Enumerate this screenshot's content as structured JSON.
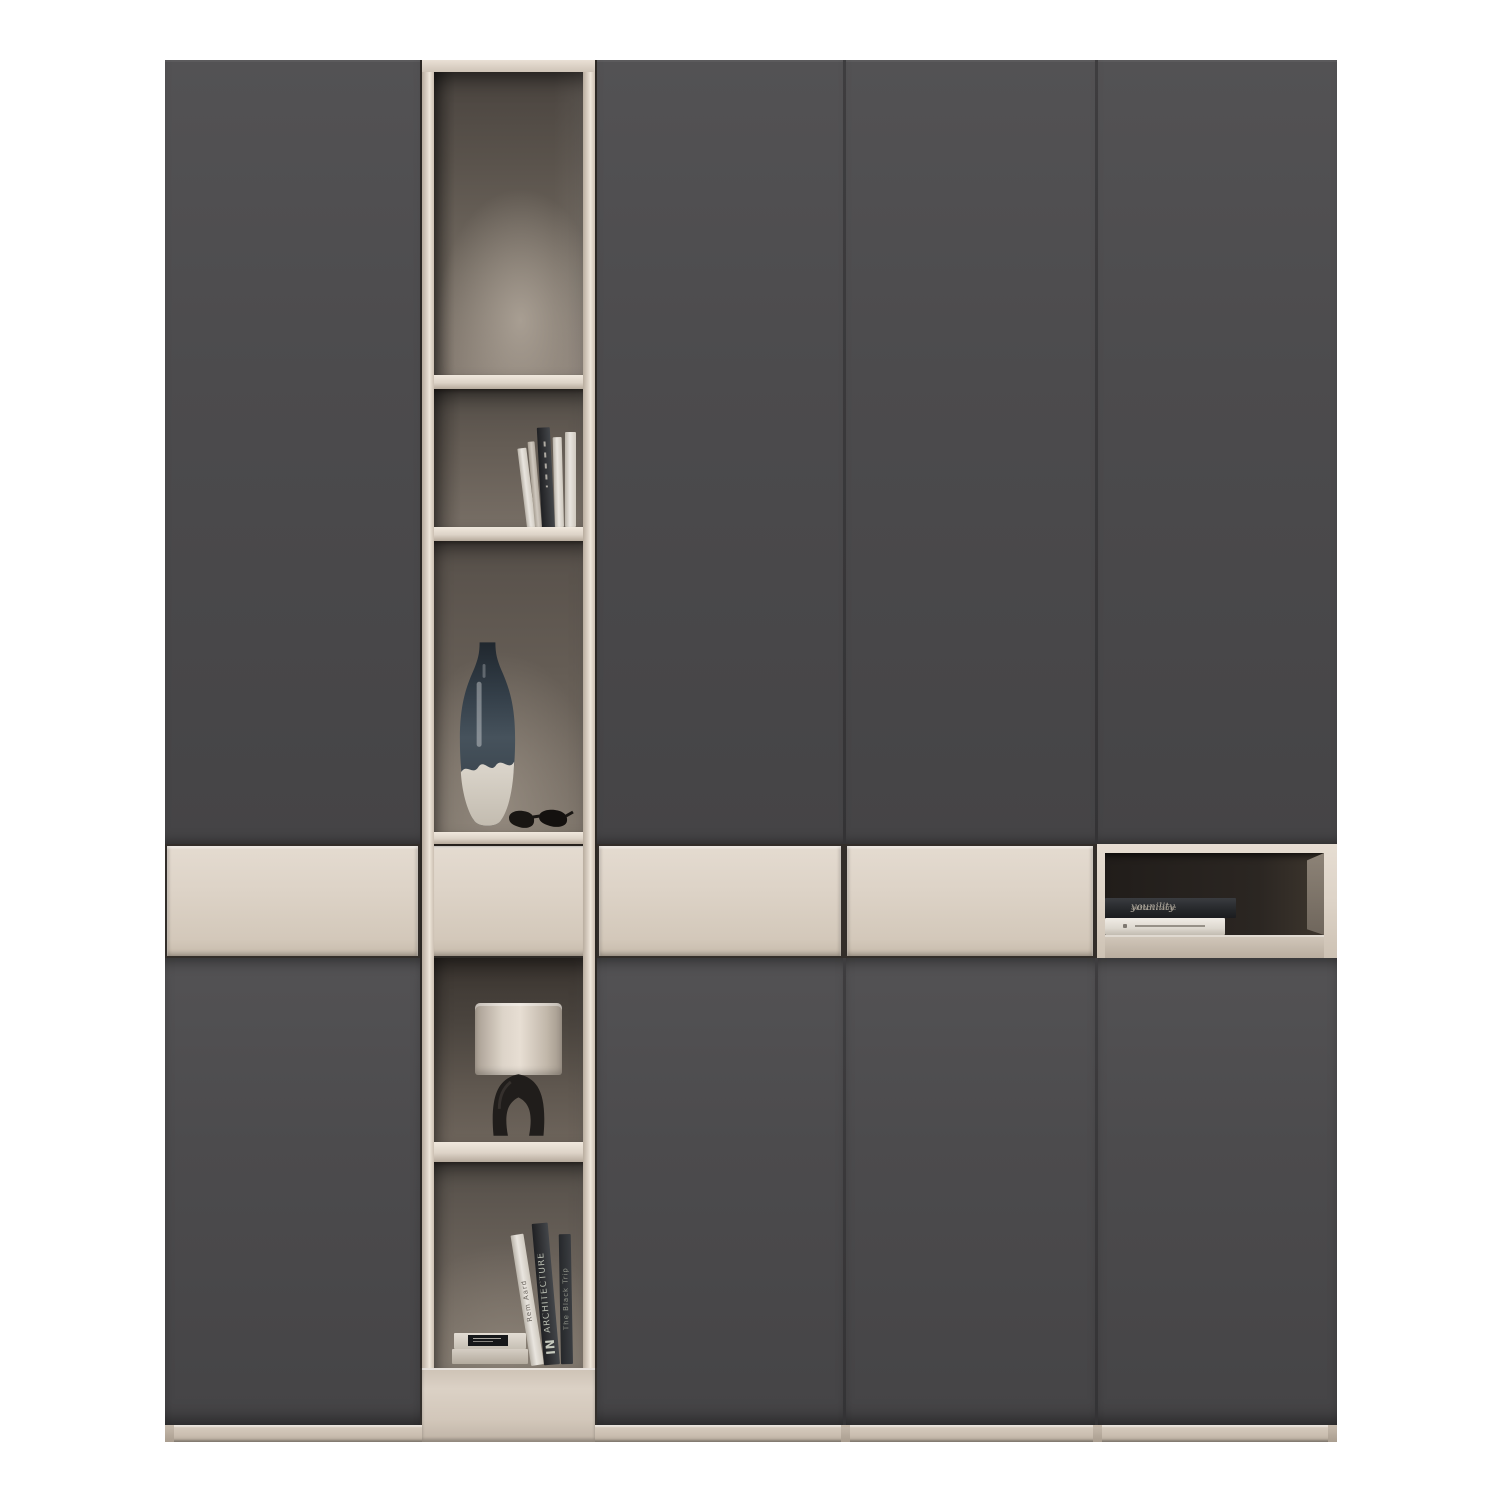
{
  "scene": {
    "type": "furniture-product-photo",
    "description": "Tall modular wardrobe: four dark grey handleless door columns, one beige open shelving column with decor, a beige drawer band across the middle, and an open niche with books at the right end",
    "background": "#ffffff"
  },
  "palette": {
    "bg": "#ffffff",
    "door": "#4c4b4d",
    "door-hi": "#535254",
    "door-lo": "#454446",
    "cream": "#ddd3c7",
    "cream-bright": "#eae1d6",
    "cream-shadow": "#b5a99b",
    "interior-dark": "#4a443f",
    "interior-light": "#a79d92",
    "niche-dark": "#241f1c",
    "dark-book": "#303134",
    "white-book": "#e9e5df",
    "vase-dark": "#2b343d",
    "vase-cream": "#d6d0c6",
    "lamp-shade": "#ddd4c9",
    "lamp-base": "#201d1b"
  },
  "structure": {
    "columns": [
      {
        "label": "left door column"
      },
      {
        "label": "open shelf column"
      },
      {
        "label": "center door column"
      },
      {
        "label": "center-right door column"
      },
      {
        "label": "right door column with open niche"
      }
    ],
    "shelf_column_cubbies": [
      {
        "label": "tall empty cubby"
      },
      {
        "label": "cubby with standing books"
      },
      {
        "label": "cubby with vase and sunglasses"
      },
      {
        "label": "cubby with table lamp"
      },
      {
        "label": "cubby with books"
      }
    ]
  },
  "decor": {
    "upper_books": {
      "label": "standing books",
      "count": 5
    },
    "vase": {
      "label": "two-tone ceramic vase"
    },
    "sunglasses": {
      "label": "black sunglasses"
    },
    "lamp": {
      "label": "table lamp, cream drum shade, black sculptural base"
    },
    "lower_books": {
      "stack": {
        "label": "two stacked books with black cover label"
      },
      "leaning": [
        {
          "title": "Rem Aard"
        },
        {
          "title": "ARCHITECTURE",
          "subtitle": "IN"
        },
        {
          "title": "The Black Trip"
        }
      ]
    },
    "niche_books": {
      "dark_book": {
        "title": "younility",
        "author": "author name"
      },
      "white_book": {
        "label": "white book"
      }
    }
  }
}
